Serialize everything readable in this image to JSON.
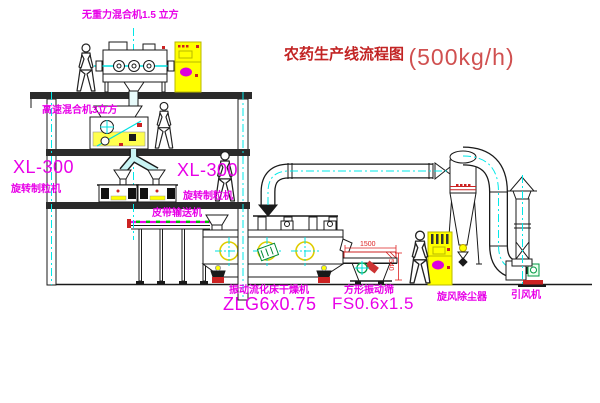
{
  "title": {
    "text": "农药生产线流程图",
    "capacity": "(500kg/h)"
  },
  "labels": {
    "top_mixer": "无重力混合机1.5 立方",
    "mid_mixer": "高速混合机3立方",
    "granulator_left_model": "XL-300",
    "granulator_left_name": "旋转制粒机",
    "granulator_right_model": "XL-300",
    "granulator_right_name": "旋转制粒机",
    "belt_conveyor": "皮带输送机",
    "dryer_name": "振动流化床干燥机",
    "dryer_model": "ZLG6x0.75",
    "sieve_name": "方形振动筛",
    "sieve_model": "FS0.6x1.5",
    "cyclone": "旋风除尘器",
    "fan": "引风机"
  },
  "dimensions": {
    "sieve_length": "1500",
    "sieve_height": "540"
  },
  "colors": {
    "label_magenta": "#e800e8",
    "title_red": "#c22424",
    "centerline_cyan": "#00f0f0",
    "equipment_yellow": "#ffff00",
    "dimension_red": "#dd2222",
    "motor_green": "#009944",
    "line_black": "#1a1a1a"
  }
}
